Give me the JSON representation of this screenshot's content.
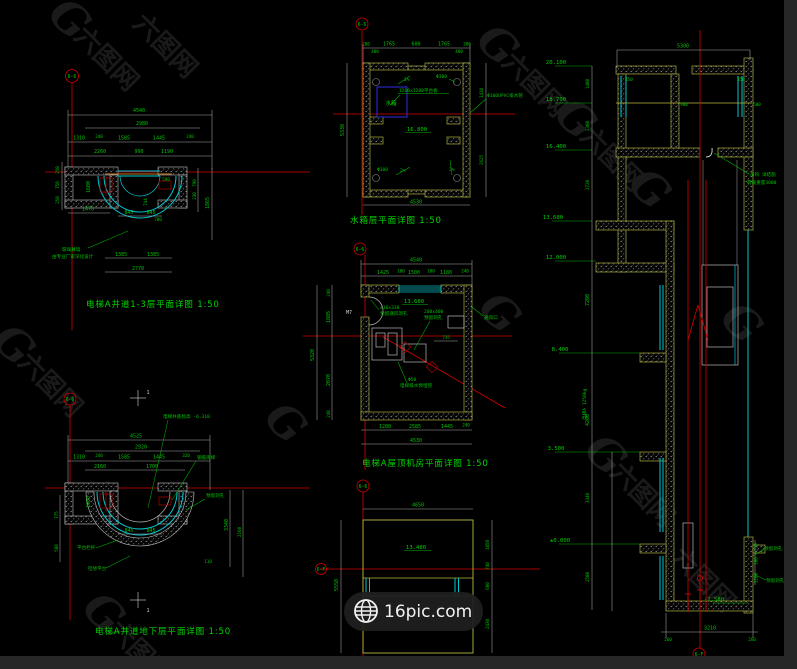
{
  "watermark": {
    "g": "G",
    "brand": "六图网"
  },
  "badge": {
    "label": "16pic.com"
  },
  "plan1": {
    "axis": "6-6",
    "title": "电梯A井道1-3层平面详图 1:50",
    "d_total": "4540",
    "d_inner": "2980",
    "row1": [
      "1310",
      "240",
      "1585",
      "1445",
      "240"
    ],
    "row2": [
      "2260",
      "990",
      "1190"
    ],
    "v_left": [
      "250",
      "750",
      "250"
    ],
    "d1600": "1600",
    "d1470": "1470",
    "d590": "590",
    "d845a": "845",
    "d845b": "845",
    "d790": "790",
    "d230": "230",
    "d1865": "1865",
    "d744": "744",
    "d700": "700",
    "b1": "1385",
    "b2": "1385",
    "b_total": "2770",
    "note1": "玻璃幕墙",
    "note2": "由专业厂家深化设计"
  },
  "plan2": {
    "axis": "6-6",
    "title": "水箱层平面详图 1:50",
    "row": [
      "200",
      "1765",
      "600",
      "1765",
      "200"
    ],
    "d480a": "480",
    "d480b": "480",
    "v_total": "5330",
    "v_r1": "1410",
    "v_r2": "2625",
    "b_total": "4530",
    "tank": "水箱",
    "platform": "1200x1200平台板",
    "level": "16.800",
    "s1": "2%",
    "s2": "2%",
    "s3": "2%",
    "h1": "Φ300",
    "h2": "Φ300",
    "pipe": "Φ100UPVC排水管"
  },
  "plan3": {
    "axis": "6-6",
    "title": "电梯A屋顶机房平面详图 1:50",
    "d_total": "4540",
    "row": [
      "1425",
      "100",
      "1500",
      "100",
      "1180",
      "240"
    ],
    "v_total": "5320",
    "v_row": [
      "240",
      "1885",
      "2070",
      "240"
    ],
    "b_row": [
      "1280",
      "2585",
      "1445",
      "240"
    ],
    "b_total": "4530",
    "level": "13.680",
    "door": "M7",
    "vent1": "430x330",
    "vent2": "预留通风洞孔",
    "hole1": "200x400",
    "hole2": "预留洞孔",
    "d735": "735",
    "louver": "通风口",
    "drain1": "Φ50",
    "drain2": "电梯排水预埋管"
  },
  "plan4": {
    "axis": "6-6",
    "marker": "1",
    "marker2": "1",
    "title": "电梯A井道地下层平面详图 1:50",
    "d_total": "4525",
    "d_inner": "2920",
    "row1": [
      "1310",
      "240",
      "1585",
      "1445",
      "320"
    ],
    "row2": [
      "2160",
      "1700"
    ],
    "d1600": "1600",
    "d580": "580",
    "d775": "775",
    "d845a": "845",
    "d845b": "845",
    "v_r1": "3340",
    "v_r2": "2160",
    "d110": "110",
    "pit_note": "电梯井底标高 -6.310",
    "ladder": "钢筋爬梯",
    "hole": "预留洞孔",
    "rail": "平台栏杆",
    "platform": "检修平台"
  },
  "plan5": {
    "axis": "6-6",
    "axis2": "6-F",
    "level": "13.480",
    "d_total": "4650",
    "v_total": "5550",
    "v_right": [
      "1850",
      "740",
      "680",
      "2430"
    ]
  },
  "section": {
    "axis": "6-F",
    "levels": [
      "20.100",
      "18.700",
      "16.400",
      "13.680",
      "12.000",
      "8.400",
      "3.500",
      "±0.000"
    ],
    "pit_level": "-2.580",
    "d_top": "5300",
    "top_small": [
      "450",
      "450",
      "900",
      "500"
    ],
    "chain": [
      "1400",
      "2300",
      "2720",
      "7200",
      "4200",
      "3340",
      "2500"
    ],
    "right_small": [
      "510",
      "200",
      "1200"
    ],
    "d_bottom": "3210",
    "b_l": "260",
    "b_r": "260",
    "hook1": "吊钩 详结施",
    "hook2": "荷载重量3000",
    "cap": "电梯A 1250kg",
    "hole1": "预留洞孔",
    "hole2": "预留洞孔"
  }
}
